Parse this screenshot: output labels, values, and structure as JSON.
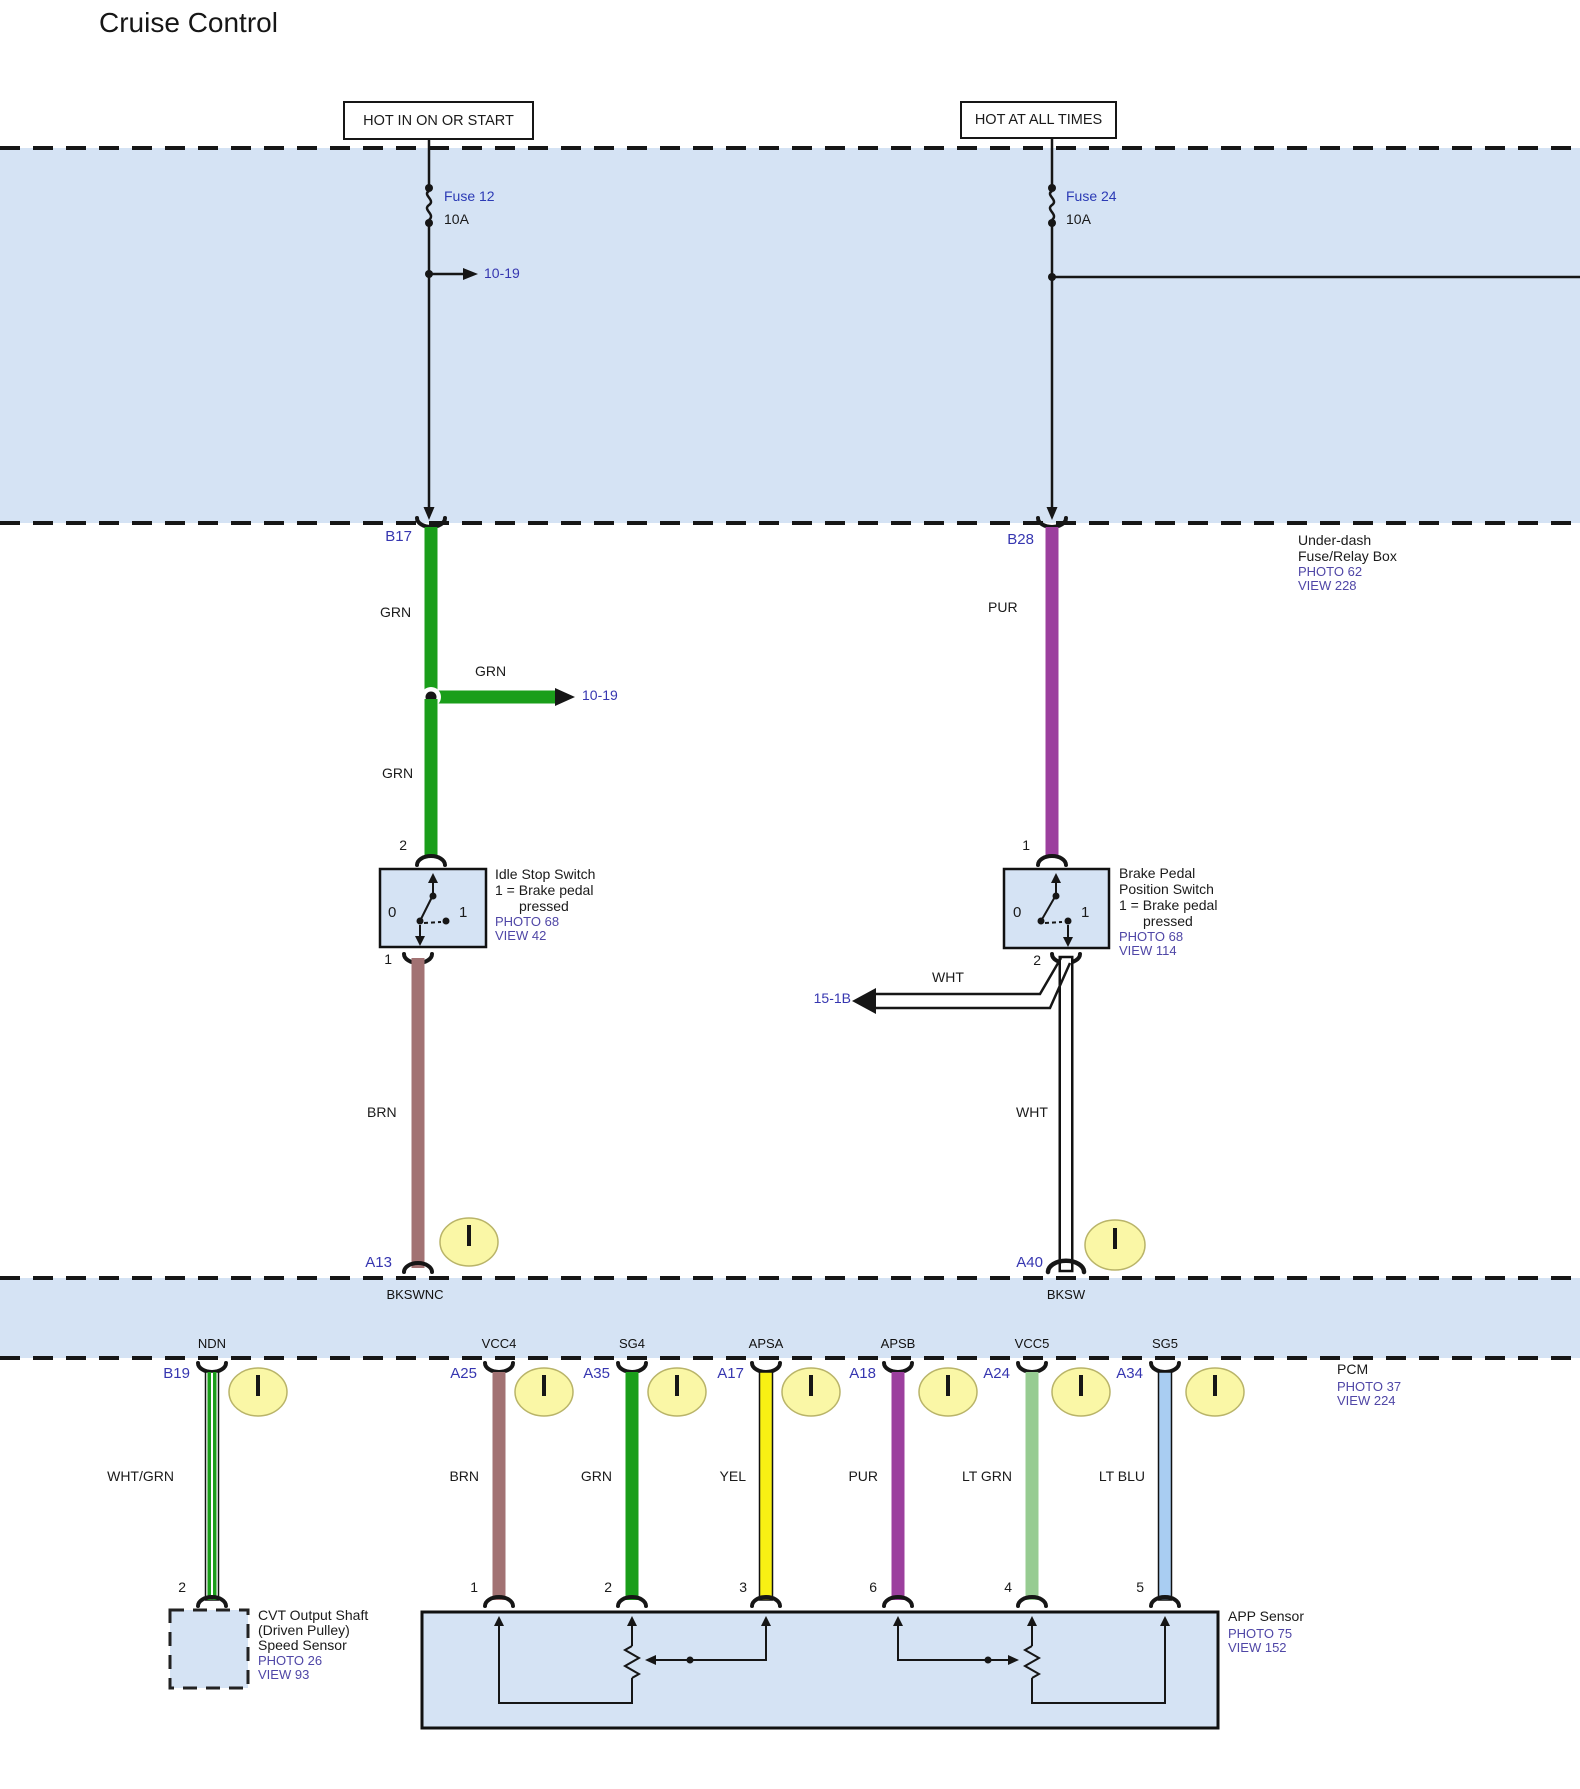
{
  "title": "Cruise Control",
  "colors": {
    "region_blue": "#d5e3f4",
    "grn": "#1a9e1a",
    "pur": "#9c3f9e",
    "brn": "#a27273",
    "yel": "#f8f014",
    "lt_grn": "#97cc92",
    "lt_blu": "#a9cdf2",
    "wht": "#ffffff",
    "wht_grn": "#1a9e1a/#ffffff",
    "connector_circle": "#faf7a6",
    "id_text": "#3636b0",
    "ref_text": "#4f46a6"
  },
  "rails": {
    "left": {
      "label": "HOT IN ON OR START",
      "fuse_name": "Fuse 12",
      "fuse_amp": "10A",
      "branch_dest": "10-19",
      "connector": "B17"
    },
    "right": {
      "label": "HOT AT ALL TIMES",
      "fuse_name": "Fuse 24",
      "fuse_amp": "10A",
      "connector": "B28"
    }
  },
  "fusebox_note": {
    "line1": "Under-dash",
    "line2": "Fuse/Relay Box",
    "photo": "PHOTO 62",
    "view": "VIEW 228"
  },
  "left_run": {
    "wire_color": "GRN",
    "branch_color": "GRN",
    "branch_dest": "10-19",
    "term_top": "2",
    "term_bottom": "1",
    "wire2_color": "BRN",
    "pin": "A13"
  },
  "right_run": {
    "wire_color": "PUR",
    "term_top": "1",
    "term_bottom": "2",
    "branch_color": "WHT",
    "branch_dest": "15-1B",
    "wire2_color": "WHT",
    "pin": "A40"
  },
  "idle_switch": {
    "name": "Idle Stop Switch",
    "note1": "1 = Brake pedal",
    "note2": "pressed",
    "photo": "PHOTO 68",
    "view": "VIEW 42",
    "pos0": "0",
    "pos1": "1"
  },
  "brake_switch": {
    "name1": "Brake Pedal",
    "name2": "Position Switch",
    "note1": "1 = Brake pedal",
    "note2": "pressed",
    "photo": "PHOTO 68",
    "view": "VIEW 114",
    "pos0": "0",
    "pos1": "1"
  },
  "pcm": {
    "label": "PCM",
    "photo": "PHOTO 37",
    "view": "VIEW 224",
    "in_names": [
      "BKSWNC",
      "BKSW"
    ],
    "out": [
      {
        "pin": "B19",
        "name": "NDN",
        "wire": "WHT/GRN",
        "terminal": "2"
      },
      {
        "pin": "A25",
        "name": "VCC4",
        "wire": "BRN",
        "terminal": "1"
      },
      {
        "pin": "A35",
        "name": "SG4",
        "wire": "GRN",
        "terminal": "2"
      },
      {
        "pin": "A17",
        "name": "APSA",
        "wire": "YEL",
        "terminal": "3"
      },
      {
        "pin": "A18",
        "name": "APSB",
        "wire": "PUR",
        "terminal": "6"
      },
      {
        "pin": "A24",
        "name": "VCC5",
        "wire": "LT GRN",
        "terminal": "4"
      },
      {
        "pin": "A34",
        "name": "SG5",
        "wire": "LT BLU",
        "terminal": "5"
      }
    ]
  },
  "cvt_sensor": {
    "line1": "CVT Output Shaft",
    "line2": "(Driven Pulley)",
    "line3": "Speed Sensor",
    "photo": "PHOTO 26",
    "view": "VIEW 93"
  },
  "app_sensor": {
    "name": "APP Sensor",
    "photo": "PHOTO 75",
    "view": "VIEW 152"
  }
}
